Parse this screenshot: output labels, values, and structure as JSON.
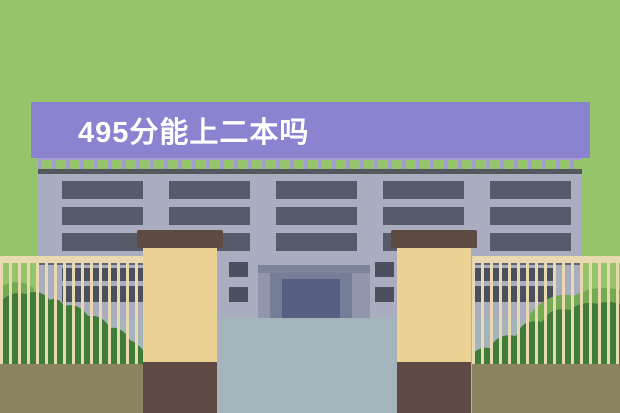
{
  "scene": {
    "width": 620,
    "height": 413,
    "description_text": ""
  },
  "banner": {
    "text": "495分能上二本吗"
  },
  "palette": {
    "bg-green": "#95c46a",
    "banner-purple": "#8a83d0",
    "banner-text": "#ffffff",
    "railing": "#a39cd1",
    "roofline": "#55575f",
    "facade": "#aaacbf",
    "frame": "#565b69",
    "frame-ground": "#4c505e",
    "glass": "#cde0f1",
    "porch": "#9196ac",
    "lintel": "#7d8399",
    "recess": "#767d99",
    "door": "#575f83",
    "pillar-cap": "#5d4a42",
    "pillar-body": "#ebd294",
    "pillar-base": "#5f4a45",
    "fence-wood": "#e9d9b1",
    "ground-line": "#63656f",
    "bush-dark": "#3f7c37",
    "bush-light": "#74ab52",
    "soil": "#8c845e",
    "courtyard": "#a3b4bd"
  },
  "building": {
    "floors": 3,
    "floor_rows_y": [
      181,
      207,
      233
    ],
    "window_groups_x": [
      62,
      169,
      276,
      383,
      490
    ],
    "group_width": 81,
    "window_height": 18,
    "panes_per_group": 4
  },
  "ground_floor": {
    "groups_x": [
      62,
      473
    ],
    "group_width": 81,
    "panes_per_group": 4,
    "rows": [
      {
        "y": 268,
        "h": 13
      },
      {
        "y": 286,
        "h": 16
      }
    ],
    "side_windows": [
      {
        "x": 229,
        "y": 262
      },
      {
        "x": 229,
        "y": 287
      },
      {
        "x": 375,
        "y": 262
      },
      {
        "x": 375,
        "y": 287
      }
    ],
    "side_width": 19,
    "side_height": 15
  }
}
